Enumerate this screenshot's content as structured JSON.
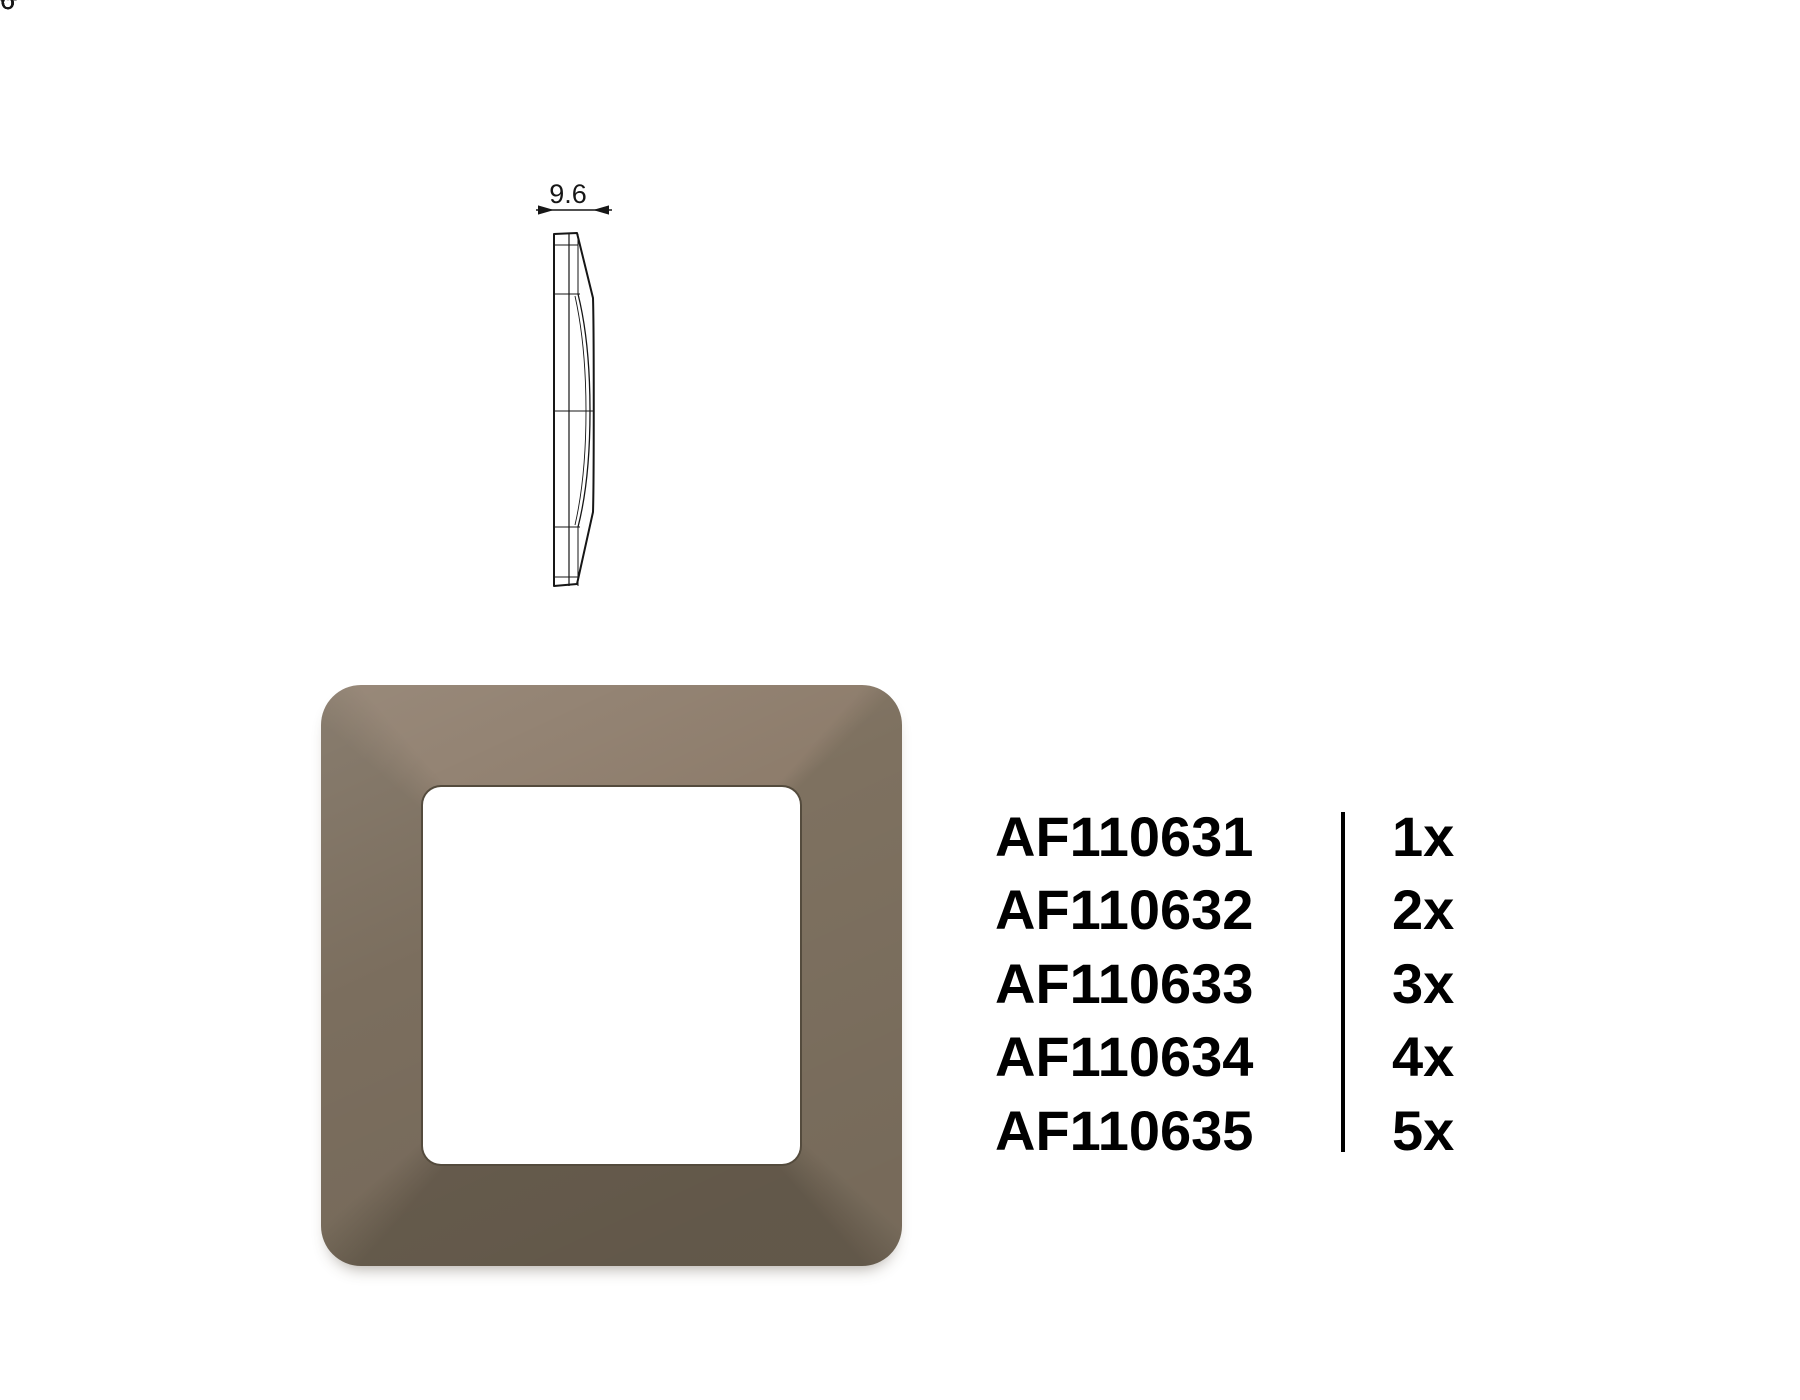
{
  "page": {
    "background": "#ffffff"
  },
  "drawings": {
    "line_color": "#161616",
    "shade_color": "#a9a9a9",
    "views": {
      "front_single": {
        "name": "single-frame-front-view",
        "gangs": 1,
        "width_label": "86",
        "height_label": "86"
      },
      "side_profile": {
        "name": "side-profile-view",
        "thickness_label": "9.6"
      },
      "gang2": {
        "name": "2-gang-frame-front-view",
        "gangs": 2,
        "width_label": "156",
        "height_label": "86"
      },
      "gang5": {
        "name": "5-gang-frame-front-view",
        "gangs": 5,
        "width_label": "370",
        "height_label": "86"
      },
      "gang3": {
        "name": "3-gang-frame-front-view",
        "gangs": 3,
        "width_label": "228",
        "height_label": "86"
      },
      "gang4": {
        "name": "4-gang-frame-front-view",
        "gangs": 4,
        "width_label": "298",
        "height_label": "86"
      }
    }
  },
  "photo": {
    "face_top": "#8d7c6b",
    "face_right": "#7e7160",
    "face_bottom": "#685d4e",
    "face_left": "#7b6e5e",
    "window_color": "#ffffff",
    "window_edge": "#544b3d"
  },
  "product_list": {
    "items": [
      {
        "code": "AF110631",
        "qty": "1x"
      },
      {
        "code": "AF110632",
        "qty": "2x"
      },
      {
        "code": "AF110633",
        "qty": "3x"
      },
      {
        "code": "AF110634",
        "qty": "4x"
      },
      {
        "code": "AF110635",
        "qty": "5x"
      }
    ]
  }
}
